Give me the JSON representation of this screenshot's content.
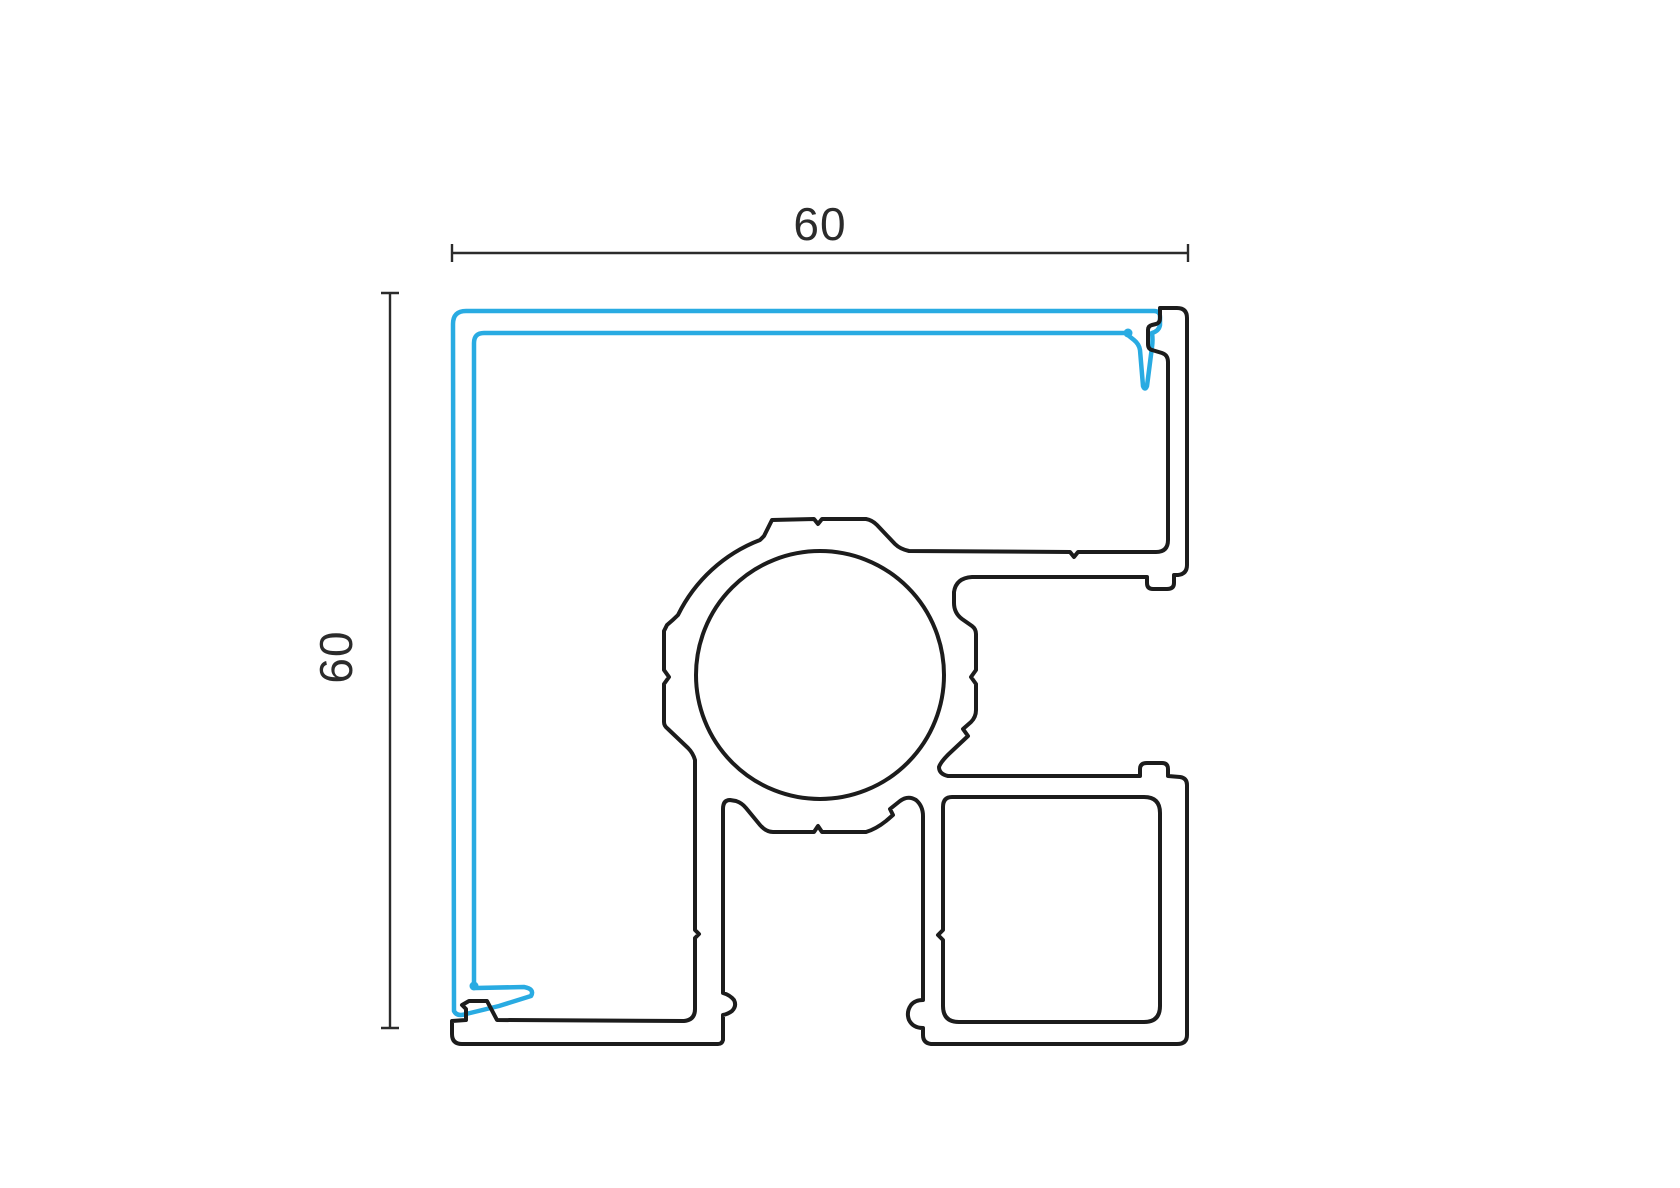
{
  "drawing": {
    "type": "technical-cross-section-corner-profile",
    "labels": {
      "width": "60",
      "height": "60"
    },
    "colors": {
      "profile_outline": "#1C1C1C",
      "gasket_line": "#29ABE2",
      "dimension_line": "#2B2B2B",
      "text": "#2B2B2B",
      "background": "#FFFFFF"
    }
  }
}
